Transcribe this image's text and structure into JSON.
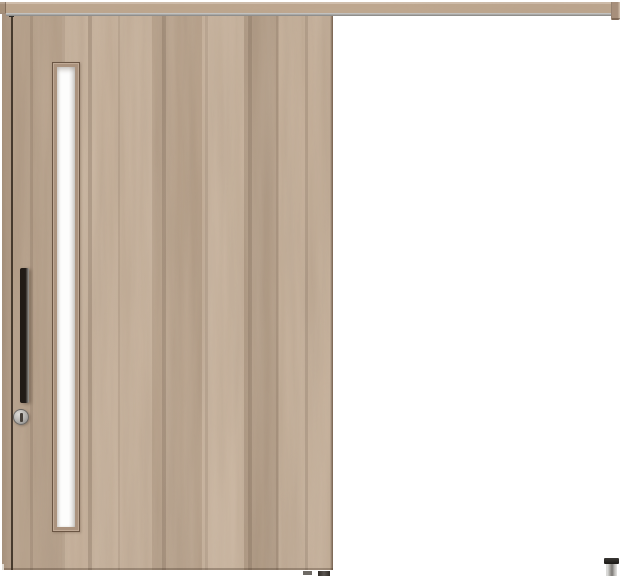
{
  "scene": {
    "description": "Product photo of a light brown wood-grain outset sliding door in closed position, hung from a full-width wooden top rail that extends to the right over a white background. The door has a tall narrow frosted-glass slit window near its left edge, a black vertical bar pull handle, a round silver thumb-turn lock below the handle, dark guide blocks under its bottom right corner, and a small cylindrical metal floor stopper with a black cap sits on the floor at the far right end of the rail.",
    "background_color": "#ffffff"
  },
  "components": {
    "top_rail": "wooden hanging rail with aluminum track strip and right end cap",
    "door_panel": "flush wood door with vertical grain planks",
    "glass_window": "narrow vertical frosted glass slit with wood frame",
    "handle": "black vertical bar pull handle",
    "lock": "round silver thumb-turn lock with vertical slot",
    "hangers": "dark roller hanger hardware at door top",
    "floor_guides": "dark guide blocks under door bottom edge",
    "floor_stopper": "cylindrical metal floor stopper with black cap"
  },
  "colors": {
    "bg": "#ffffff",
    "wood-base": "#bda68f",
    "groove": "#372b20",
    "rail-base": "#c0a991",
    "rail-highlight": "#d4c2b0",
    "rail-end": "#a78f7b",
    "track-light": "#cfcfcd",
    "track-dark": "#84827f",
    "glass-frame": "#ab937e",
    "glass-frame-line": "#6a5543",
    "glass-white": "#fdfdfc",
    "glass-shade": "#d5d4d1",
    "handle-dark": "#211b16",
    "handle-mid": "#4f4a44",
    "handle-sheen": "#9b9995",
    "knob-light": "#dedcd8",
    "knob-mid": "#b2b0ac",
    "knob-dark": "#838180",
    "knob-slot": "#453f39",
    "hardware": "#2e2a25",
    "guide-dark": "#302c28",
    "guide-gray": "#6e6a65",
    "stopper-cap": "#1b1917",
    "stopper-light": "#dadad8",
    "stopper-shade": "#7b7875",
    "door-bottom-light": "#e2dcd4"
  }
}
